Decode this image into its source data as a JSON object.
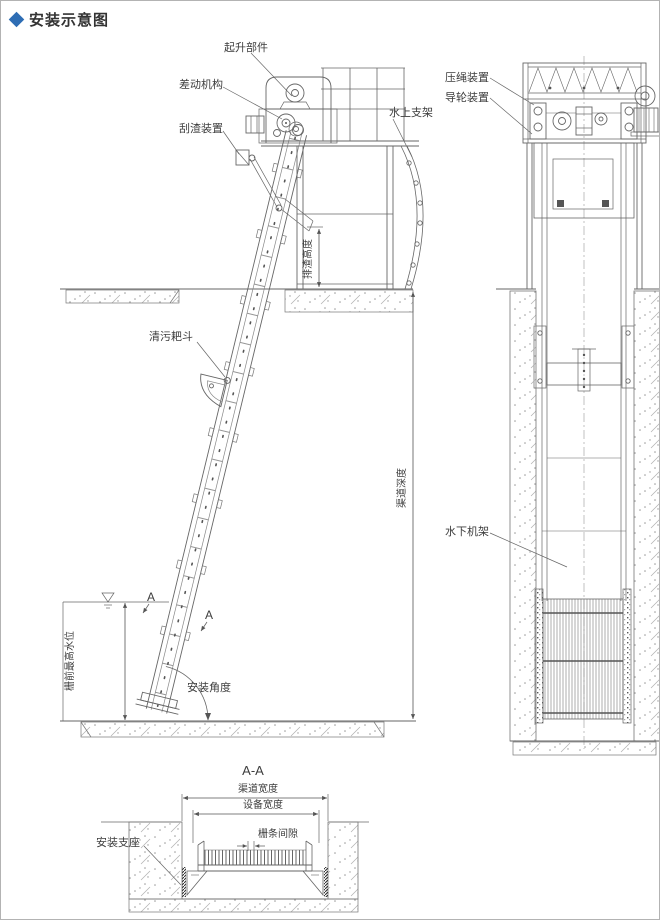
{
  "title": {
    "text": "安装示意图"
  },
  "left_view": {
    "hoist_label": "起升部件",
    "differential_label": "差动机构",
    "scraper_label": "刮渣装置",
    "water_support_label": "水上支架",
    "rake_bucket_label": "清污耙斗",
    "discharge_height_dim": "排渣高度",
    "max_water_level_dim": "栅前最高水位",
    "install_angle_label": "安装角度",
    "channel_depth_dim": "渠道深度",
    "section_marker": "A"
  },
  "right_view": {
    "rope_press_label": "压绳装置",
    "guide_wheel_label": "导轮装置",
    "underwater_frame_label": "水下机架"
  },
  "section_aa": {
    "title": "A-A",
    "channel_width_dim": "渠道宽度",
    "equipment_width_dim": "设备宽度",
    "bar_gap_dim": "栅条间隙",
    "mount_base_label": "安装支座"
  },
  "colors": {
    "accent_blue": "#2e6db4",
    "line_gray": "#666666",
    "text_gray": "#3d3d3d"
  }
}
